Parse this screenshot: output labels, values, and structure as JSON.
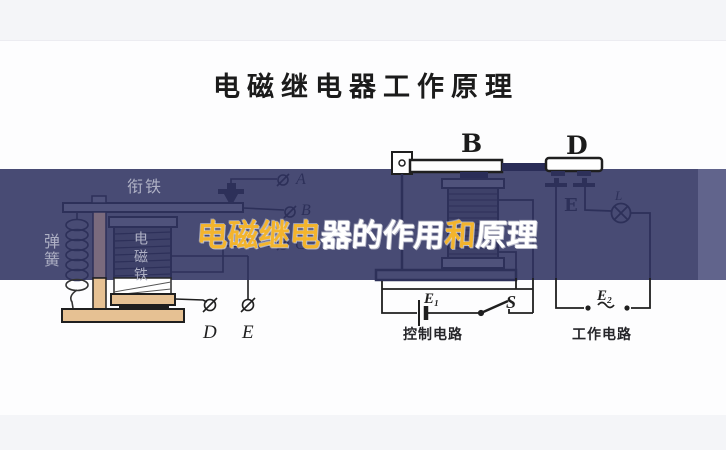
{
  "meta": {
    "band_color": "#484b74",
    "band_light_strip": "#61648c",
    "ink_black": "#1f1f1f",
    "ink_navy": "#2d3059",
    "label_gray": "#aeb0c4",
    "beige": "#e6c193",
    "overlay_yellow": "#f3b42d",
    "overlay_white": "#ffffff"
  },
  "header": {
    "title": "电磁继电器工作原理"
  },
  "overlay_title": {
    "text": "电磁继电器的作用和原理",
    "chars": [
      {
        "ch": "电",
        "color": "yellow"
      },
      {
        "ch": "磁",
        "color": "yellow"
      },
      {
        "ch": "继",
        "color": "yellow"
      },
      {
        "ch": "电",
        "color": "yellow"
      },
      {
        "ch": "器",
        "color": "white"
      },
      {
        "ch": "的",
        "color": "white"
      },
      {
        "ch": "作",
        "color": "white"
      },
      {
        "ch": "用",
        "color": "white"
      },
      {
        "ch": "和",
        "color": "yellow"
      },
      {
        "ch": "原",
        "color": "white"
      },
      {
        "ch": "理",
        "color": "white"
      }
    ]
  },
  "left_diagram": {
    "armature_label": "衔铁",
    "spring_label": "弹簧",
    "coil_label": "电磁铁",
    "terminal_a": "A",
    "terminal_b": "B",
    "terminal_c": "C",
    "terminal_d": "D",
    "terminal_e": "E"
  },
  "right_diagram": {
    "bar_b": "B",
    "bar_d": "D",
    "contact_e": "E",
    "lamp": "L",
    "battery": "E₁",
    "switch": "S",
    "source": "E₂",
    "control_label": "控制电路",
    "work_label": "工作电路"
  }
}
